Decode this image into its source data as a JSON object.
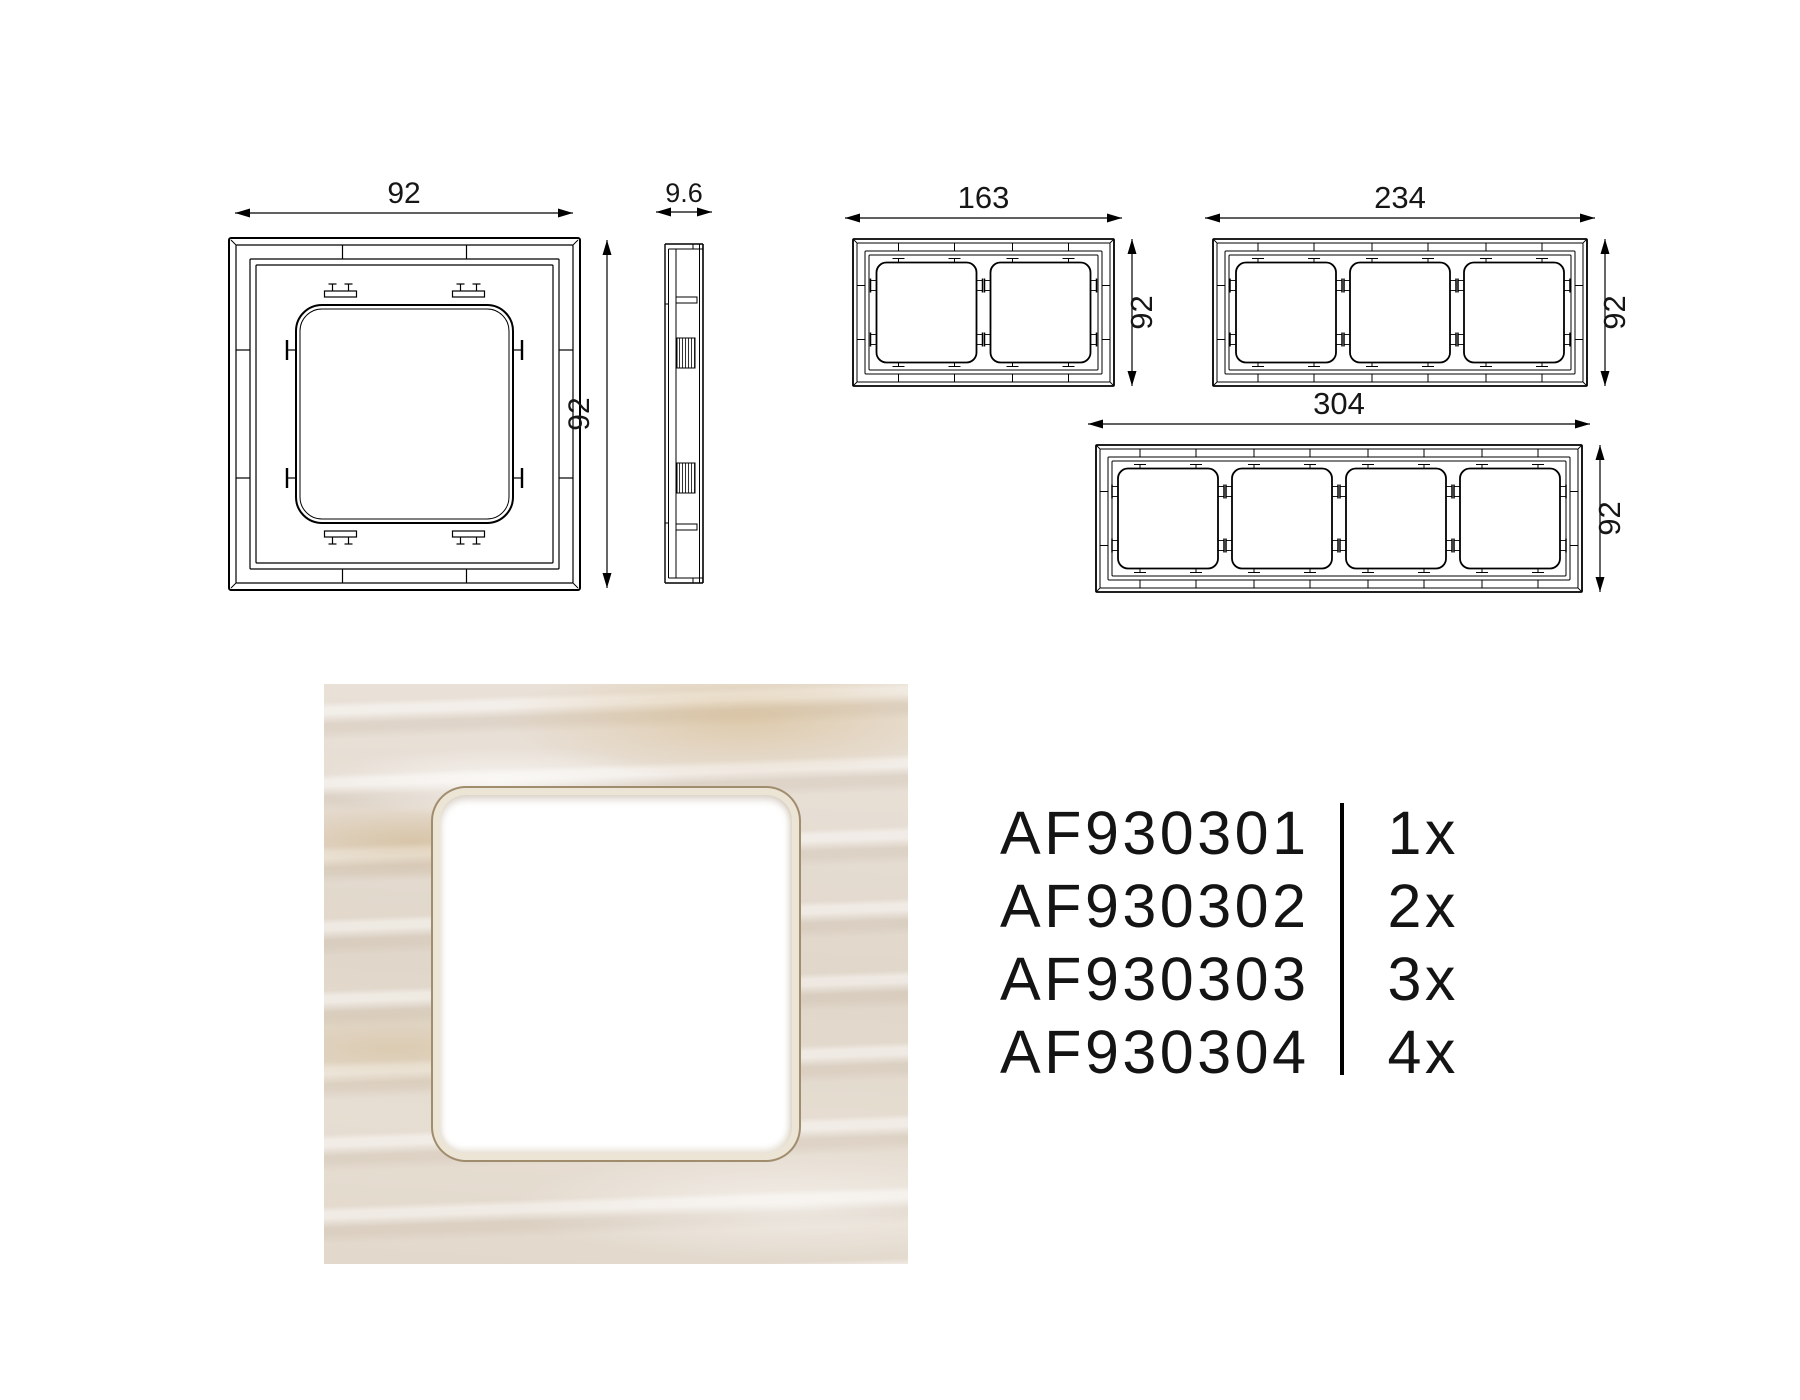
{
  "page": {
    "background": "#ffffff"
  },
  "technical_drawings": {
    "stroke_color": "#000000",
    "one_gang_front_view": {
      "width_label": "92",
      "height_label": "92"
    },
    "side_view": {
      "thickness_label": "9.6"
    },
    "two_gang_front_view": {
      "width_label": "163",
      "height_label": "92"
    },
    "three_gang_front_view": {
      "width_label": "234",
      "height_label": "92"
    },
    "four_gang_front_view": {
      "width_label": "304",
      "height_label": "92"
    }
  },
  "product_photo": {
    "description": "marble-finish cover frame with white central opening",
    "finish_colors": {
      "base": "#e7dfd6",
      "vein": "#d3b284",
      "bevel": "#ece5d5"
    }
  },
  "order_codes": {
    "divider_color": "#000000",
    "rows": [
      {
        "code": "AF930301",
        "quantity": "1x"
      },
      {
        "code": "AF930302",
        "quantity": "2x"
      },
      {
        "code": "AF930303",
        "quantity": "3x"
      },
      {
        "code": "AF930304",
        "quantity": "4x"
      }
    ]
  }
}
